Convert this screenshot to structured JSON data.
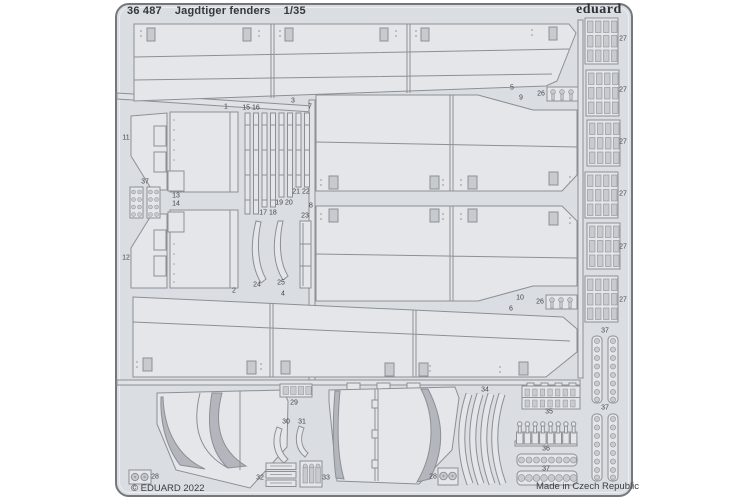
{
  "header": {
    "catalog_number": "36 487",
    "product_title": "Jagdtiger fenders",
    "scale": "1/35",
    "brand_logo": "eduard"
  },
  "footer": {
    "copyright": "© EDUARD 2022",
    "origin": "Made in Czech Republic"
  },
  "sheet_colors": {
    "page_background": "#ffffff",
    "sheet_fill": "#dadde2",
    "part_fill": "#e4e6ea",
    "outline": "#8c9094",
    "hole_fill": "#c7cacf",
    "shadow_fill": "#b3b7bd",
    "text": "#3a3d41"
  },
  "part_labels": [
    {
      "text": "1",
      "x": 226,
      "y": 107
    },
    {
      "text": "3",
      "x": 293,
      "y": 101
    },
    {
      "text": "7",
      "x": 310,
      "y": 107
    },
    {
      "text": "5",
      "x": 512,
      "y": 88
    },
    {
      "text": "9",
      "x": 521,
      "y": 98
    },
    {
      "text": "26",
      "x": 541,
      "y": 94
    },
    {
      "text": "11",
      "x": 126,
      "y": 138
    },
    {
      "text": "37",
      "x": 145,
      "y": 182
    },
    {
      "text": "13",
      "x": 176,
      "y": 196
    },
    {
      "text": "14",
      "x": 176,
      "y": 204
    },
    {
      "text": "12",
      "x": 126,
      "y": 258
    },
    {
      "text": "15 16",
      "x": 251,
      "y": 108
    },
    {
      "text": "17 18",
      "x": 268,
      "y": 213
    },
    {
      "text": "19 20",
      "x": 284,
      "y": 203
    },
    {
      "text": "21 22",
      "x": 301,
      "y": 192
    },
    {
      "text": "23",
      "x": 305,
      "y": 216
    },
    {
      "text": "24",
      "x": 257,
      "y": 285
    },
    {
      "text": "25",
      "x": 281,
      "y": 283
    },
    {
      "text": "8",
      "x": 311,
      "y": 206
    },
    {
      "text": "2",
      "x": 234,
      "y": 291
    },
    {
      "text": "4",
      "x": 283,
      "y": 294
    },
    {
      "text": "10",
      "x": 520,
      "y": 298
    },
    {
      "text": "6",
      "x": 511,
      "y": 309
    },
    {
      "text": "26",
      "x": 540,
      "y": 302
    },
    {
      "text": "27",
      "x": 623,
      "y": 39
    },
    {
      "text": "27",
      "x": 623,
      "y": 90
    },
    {
      "text": "27",
      "x": 623,
      "y": 142
    },
    {
      "text": "27",
      "x": 623,
      "y": 194
    },
    {
      "text": "27",
      "x": 623,
      "y": 247
    },
    {
      "text": "27",
      "x": 623,
      "y": 300
    },
    {
      "text": "37",
      "x": 605,
      "y": 331
    },
    {
      "text": "37",
      "x": 605,
      "y": 408
    },
    {
      "text": "34",
      "x": 485,
      "y": 390
    },
    {
      "text": "35",
      "x": 549,
      "y": 412
    },
    {
      "text": "36",
      "x": 546,
      "y": 449
    },
    {
      "text": "37",
      "x": 546,
      "y": 469
    },
    {
      "text": "29",
      "x": 294,
      "y": 403
    },
    {
      "text": "30",
      "x": 286,
      "y": 422
    },
    {
      "text": "31",
      "x": 302,
      "y": 422
    },
    {
      "text": "28",
      "x": 155,
      "y": 477
    },
    {
      "text": "32",
      "x": 260,
      "y": 478
    },
    {
      "text": "33",
      "x": 326,
      "y": 478
    },
    {
      "text": "28",
      "x": 433,
      "y": 477
    }
  ]
}
